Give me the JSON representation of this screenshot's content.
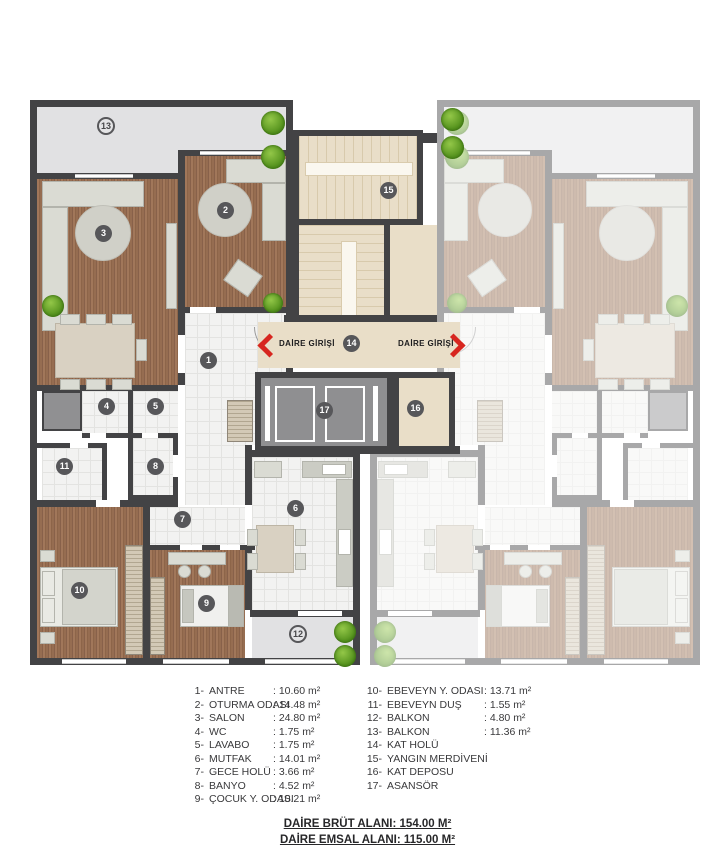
{
  "plan": {
    "entrance_label": "DAİRE GİRİŞİ",
    "badges": {
      "b1": "1",
      "b2": "2",
      "b3": "3",
      "b4": "4",
      "b5": "5",
      "b6": "6",
      "b7": "7",
      "b8": "8",
      "b9": "9",
      "b10": "10",
      "b11": "11",
      "b12": "12",
      "b13": "13",
      "b14": "14",
      "b15": "15",
      "b16": "16",
      "b17": "17"
    },
    "colors": {
      "accent_red": "#d7261f",
      "wall": "#434345",
      "wood": "#966d51",
      "beige": "#e9dec8",
      "balcony_gray": "#e1e1e3",
      "plant_green": "#57941f"
    }
  },
  "legend": {
    "col1": [
      {
        "num": "1-",
        "name": "ANTRE",
        "area": ": 10.60 m²"
      },
      {
        "num": "2-",
        "name": "OTURMA ODASI",
        "area": ": 14.48 m²"
      },
      {
        "num": "3-",
        "name": "SALON",
        "area": ": 24.80 m²"
      },
      {
        "num": "4-",
        "name": "WC",
        "area": ": 1.75 m²"
      },
      {
        "num": "5-",
        "name": "LAVABO",
        "area": ": 1.75 m²"
      },
      {
        "num": "6-",
        "name": "MUTFAK",
        "area": ": 14.01 m²"
      },
      {
        "num": "7-",
        "name": "GECE HOLÜ",
        "area": ": 3.66 m²"
      },
      {
        "num": "8-",
        "name": "BANYO",
        "area": ": 4.52 m²"
      },
      {
        "num": "9-",
        "name": "ÇOCUK Y. ODASI",
        "area": ": 10.21 m²"
      }
    ],
    "col2": [
      {
        "num": "10-",
        "name": "EBEVEYN Y. ODASI",
        "area": ": 13.71 m²"
      },
      {
        "num": "11-",
        "name": "EBEVEYN DUŞ",
        "area": ": 1.55 m²"
      },
      {
        "num": "12-",
        "name": "BALKON",
        "area": ": 4.80 m²"
      },
      {
        "num": "13-",
        "name": "BALKON",
        "area": ": 11.36 m²"
      },
      {
        "num": "14-",
        "name": "KAT HOLÜ",
        "area": ""
      },
      {
        "num": "15-",
        "name": "YANGIN MERDİVENİ",
        "area": ""
      },
      {
        "num": "16-",
        "name": "KAT DEPOSU",
        "area": ""
      },
      {
        "num": "17-",
        "name": "ASANSÖR",
        "area": ""
      }
    ]
  },
  "totals": {
    "brut": "DAİRE BRÜT ALANI: 154.00 M²",
    "emsal": "DAİRE EMSAL ALANI: 115.00 M²"
  }
}
